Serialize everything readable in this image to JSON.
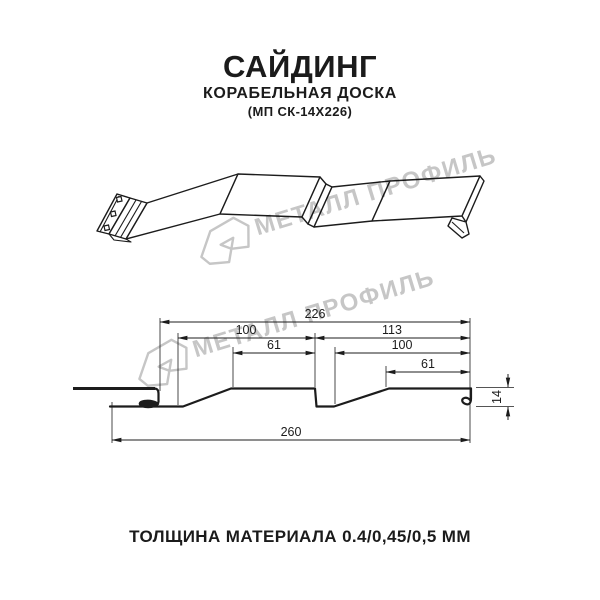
{
  "page": {
    "title": "САЙДИНГ",
    "subtitle": "КОРАБЕЛЬНАЯ ДОСКА",
    "product_code": "(МП СК-14Х226)",
    "thickness_note": "ТОЛЩИНА МАТЕРИАЛА 0.4/0,45/0,5 ММ"
  },
  "watermark": {
    "brand": "МЕТАЛЛ ПРОФИЛЬ",
    "color": "#c6c6c6"
  },
  "cross_section": {
    "dims": {
      "overall_top": "226",
      "left_pitch": "100",
      "right_pitch": "113",
      "left_top_flat": "61",
      "right_inner": "100",
      "right_top_flat": "61",
      "overall_bottom": "260",
      "profile_height": "14"
    }
  },
  "colors": {
    "line": "#1c1c1c",
    "watermark": "#c6c6c6",
    "background": "#ffffff"
  }
}
